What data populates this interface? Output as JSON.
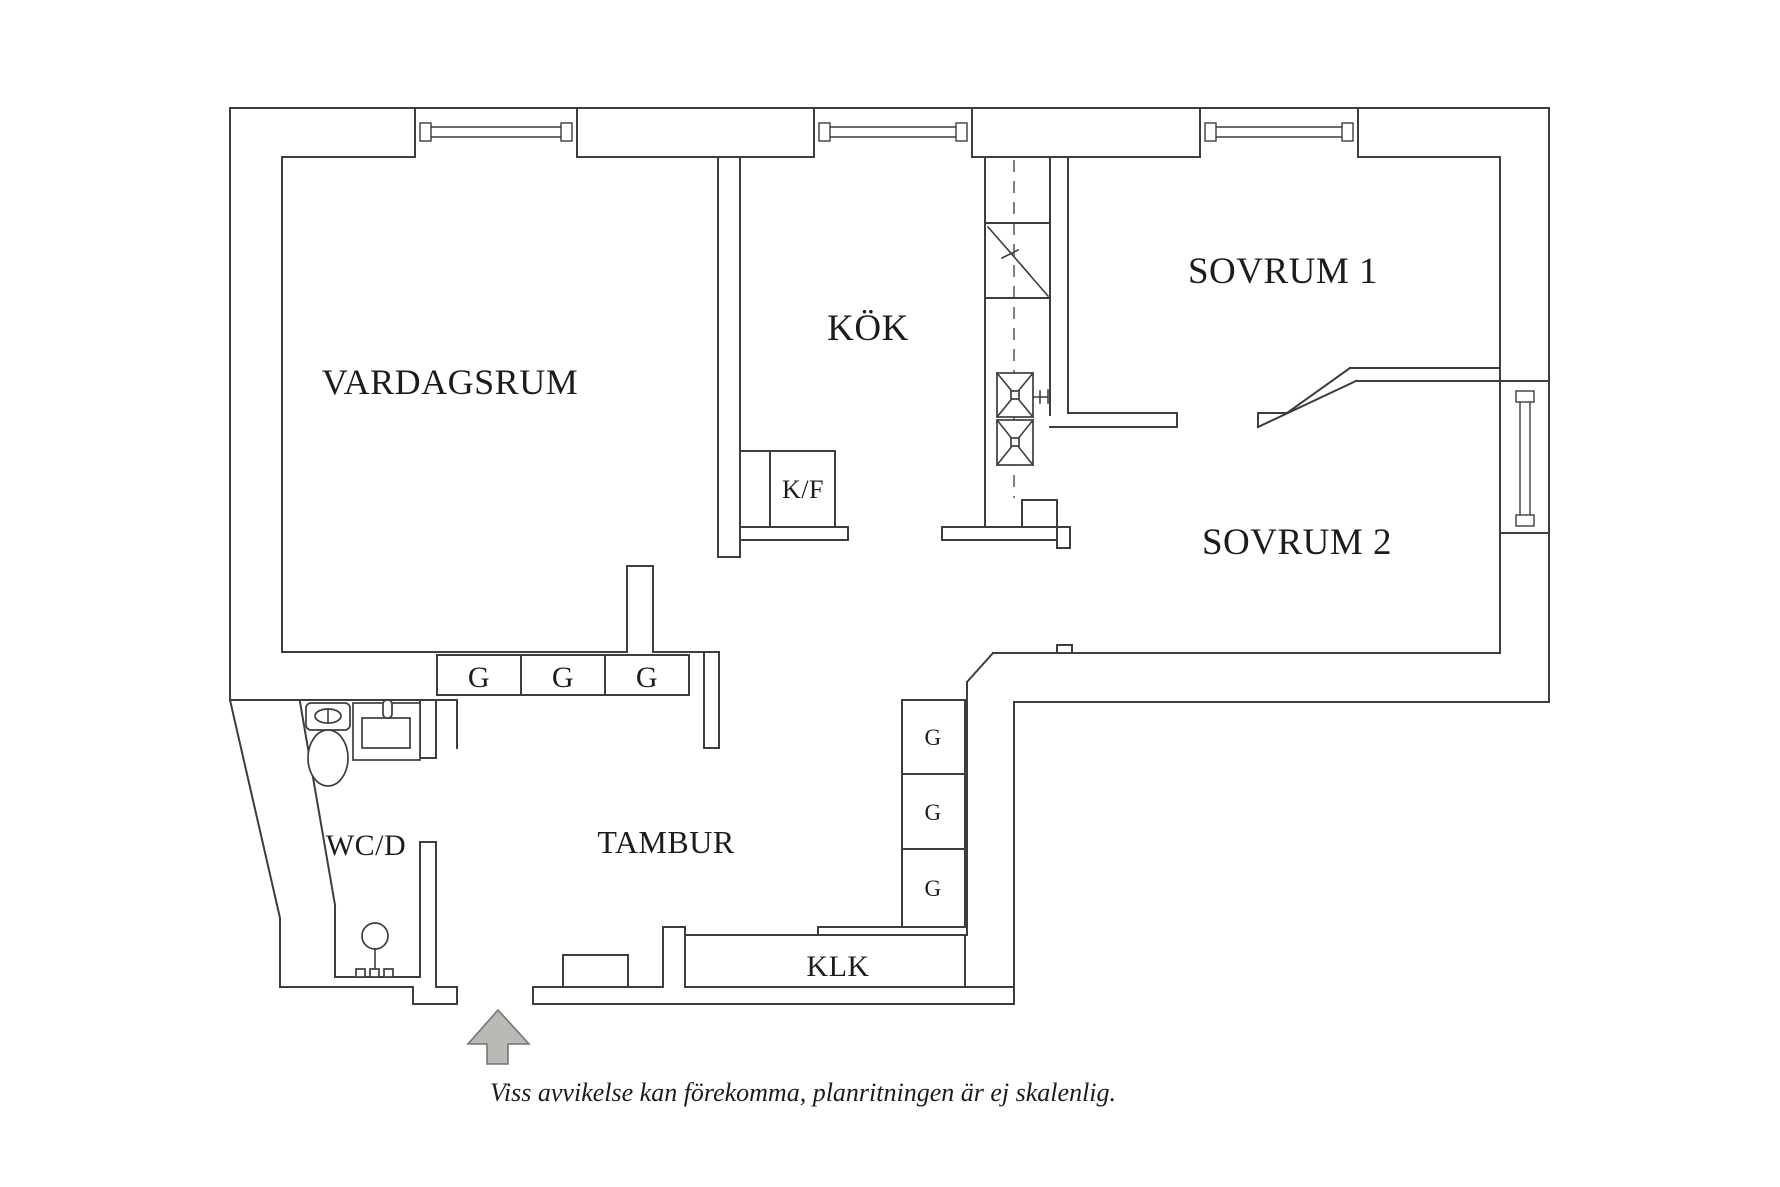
{
  "plan": {
    "rooms": {
      "vardagsrum": {
        "label": "VARDAGSRUM"
      },
      "kok": {
        "label": "KÖK"
      },
      "sovrum1": {
        "label": "SOVRUM 1"
      },
      "sovrum2": {
        "label": "SOVRUM 2"
      },
      "tambur": {
        "label": "TAMBUR"
      },
      "wcd": {
        "label": "WC/D"
      },
      "klk": {
        "label": "KLK"
      }
    },
    "appliances": {
      "fridge_freezer_label": "K/F"
    },
    "wardrobes": {
      "row": [
        "G",
        "G",
        "G"
      ],
      "column": [
        "G",
        "G",
        "G"
      ]
    }
  },
  "annotations": {
    "disclaimer": "Viss avvikelse kan förekomma, planritningen är ej skalenlig."
  },
  "colors": {
    "wall_line": "#3d3d3d",
    "label_text": "#1c1c1a",
    "arrow_fill": "#b9b9b5",
    "arrow_stroke": "#76766f",
    "background": "#ffffff"
  }
}
